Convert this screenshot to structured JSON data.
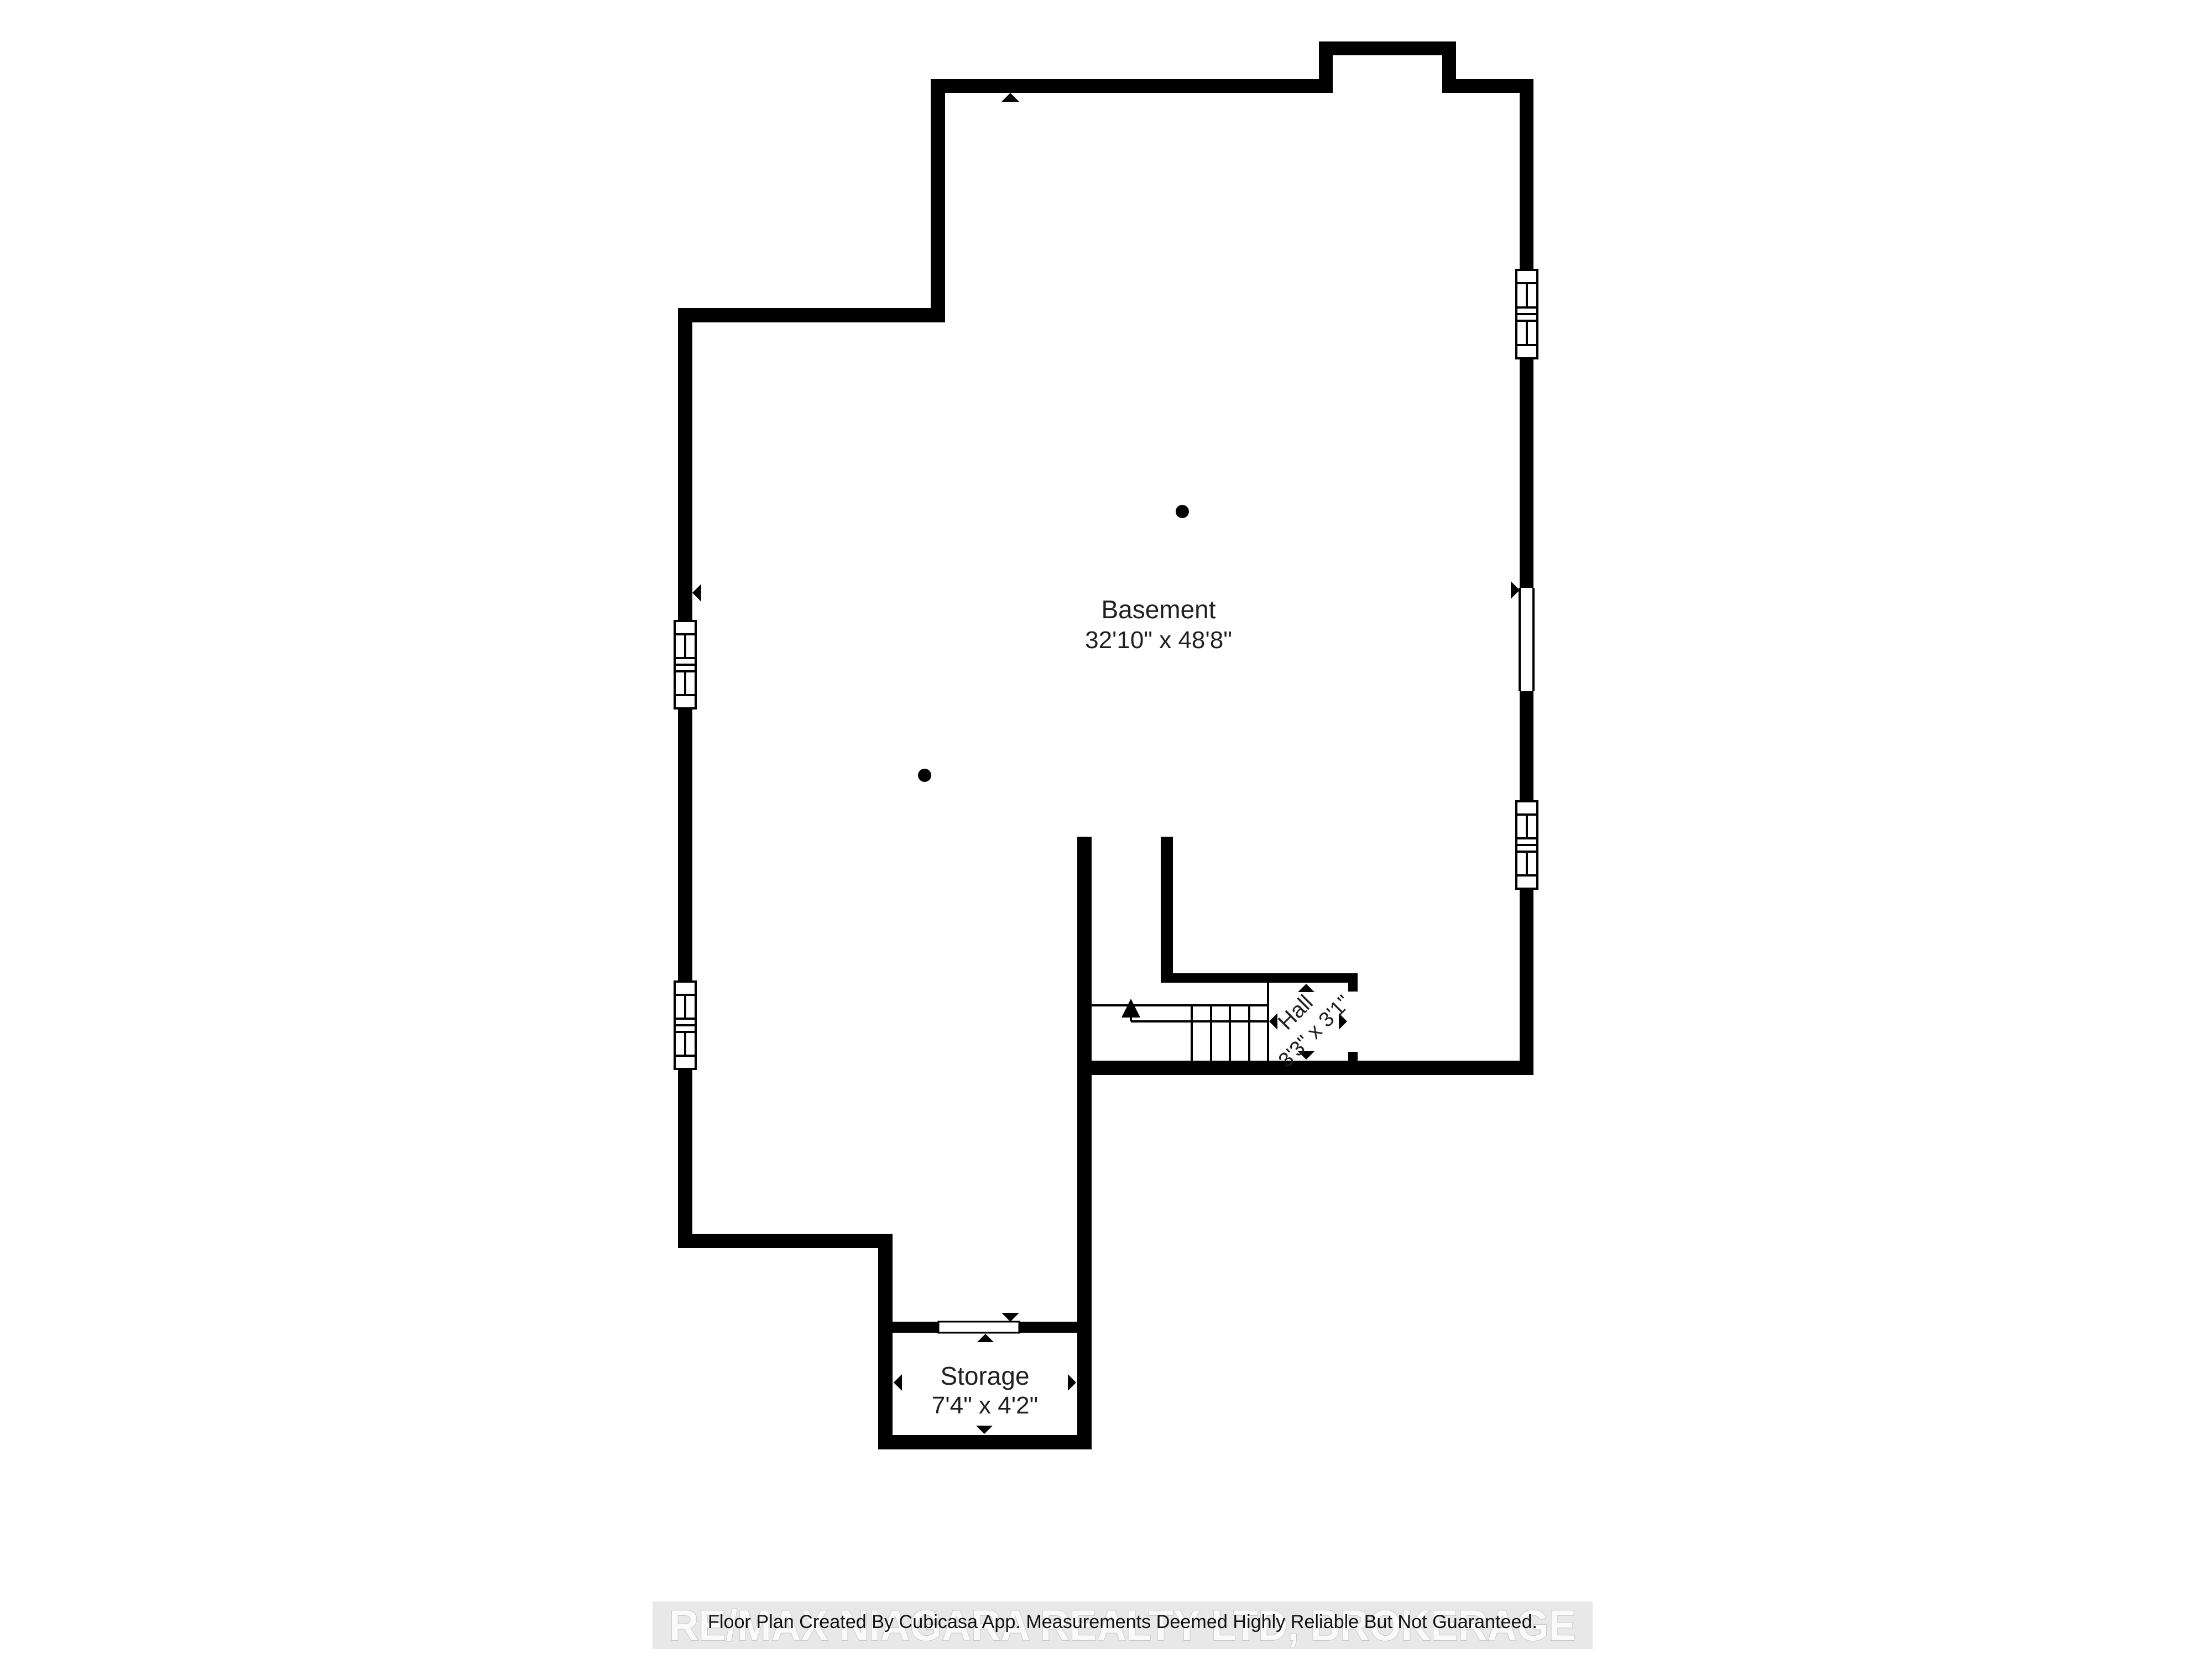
{
  "title": "Basement Floor Plan",
  "rooms": [
    {
      "name": "Basement",
      "dimensions": "32'10\" x 48'8\""
    },
    {
      "name": "Hall",
      "dimensions": "3'3\" x 3'1\""
    },
    {
      "name": "Storage",
      "dimensions": "7'4\" x 4'2\""
    }
  ],
  "footer": {
    "disclaimer": "Floor Plan Created By Cubicasa App. Measurements Deemed Highly Reliable But Not Guaranteed.",
    "watermark": "RE/MAX NIAGARA REALTY LTD, BROKERAGE"
  },
  "colors": {
    "background": "#ffffff",
    "walls": "#000000",
    "text": "#1f1f1f",
    "watermark_band": "#e8e8e8",
    "watermark_text": "#fafafa",
    "watermark_outline": "#c9c9c9"
  },
  "features": {
    "windows": 4,
    "wall_opening": 1,
    "storage_door_opening": 1,
    "stairs": {
      "treads": 5,
      "direction": "up-arrow"
    },
    "support_columns": 2,
    "dimension_markers": 12
  }
}
